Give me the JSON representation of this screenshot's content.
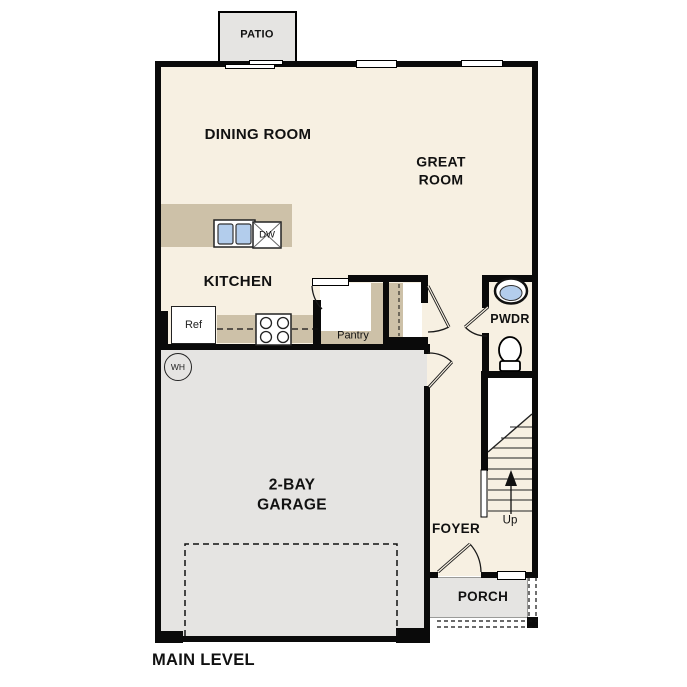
{
  "plan_title": "MAIN LEVEL",
  "rooms": {
    "patio": {
      "label": "PATIO"
    },
    "dining_room": {
      "label": "DINING ROOM"
    },
    "great_room": {
      "label": "GREAT\nROOM"
    },
    "kitchen": {
      "label": "KITCHEN"
    },
    "pantry": {
      "label": "Pantry"
    },
    "powder_room": {
      "label": "PWDR"
    },
    "garage": {
      "label": "2-BAY\nGARAGE"
    },
    "foyer": {
      "label": "FOYER"
    },
    "porch": {
      "label": "PORCH"
    }
  },
  "fixtures": {
    "refrigerator": "Ref",
    "dishwasher": "DW",
    "water_heater": "WH",
    "stairs_direction": "Up"
  },
  "colors": {
    "floor": "#f7f0e2",
    "walls": "#0a0a0a",
    "counters": "#cdc1a8",
    "exterior_concrete": "#e5e4e2",
    "sink_blue": "#b3cdec"
  }
}
